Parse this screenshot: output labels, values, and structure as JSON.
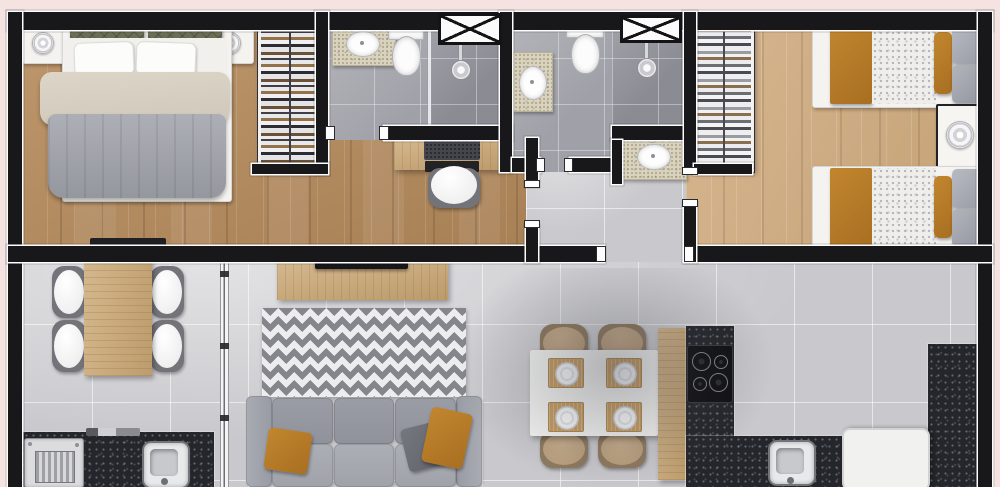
{
  "meta": {
    "title": "apartment-floor-plan",
    "description": "Top-down 3D rendered floor plan of a two-bedroom apartment, no visible text labels"
  },
  "palette": {
    "pink": "#f4e3e0",
    "wall": "#18181b",
    "woodA1": "#b68b5c",
    "woodA2": "#a67c4d",
    "woodB1": "#cfa97b",
    "tile": "#c9c9cd",
    "bath": "#a0a1a8",
    "bathdark": "#8a8b93",
    "granite": "#24262b",
    "speck": "#d9d2bd",
    "mustard": "#c2862e",
    "olive": "#6a6e55",
    "sofagray": "#9a9ca5",
    "rugzig": "#85868c",
    "rugbg": "#ededef",
    "tan": "#b69b79",
    "woodfurn": "#cba874",
    "whitefurn": "#f4f3f0"
  },
  "regions": {
    "master_bedroom": {
      "label": "master bedroom",
      "floor": "wood",
      "furniture": [
        "double-bed",
        "nightstand-left",
        "nightstand-right",
        "table-lamps",
        "open-wardrobe",
        "tv-shelf"
      ]
    },
    "master_bathroom": {
      "label": "master bathroom",
      "floor": "gray tile",
      "furniture": [
        "vanity-sink",
        "toilet",
        "walk-in-shower",
        "shower-glass"
      ]
    },
    "home_office": {
      "label": "home office nook",
      "floor": "wood",
      "furniture": [
        "desk",
        "laptop",
        "desk-chair"
      ]
    },
    "hallway": {
      "label": "hallway",
      "floor": "light tile"
    },
    "bathroom_2": {
      "label": "second bathroom",
      "floor": "gray tile",
      "furniture": [
        "vanity-sink",
        "toilet",
        "walk-in-shower"
      ]
    },
    "washbasin_nook": {
      "label": "washbasin nook",
      "floor": "light tile",
      "furniture": [
        "washbasin-vanity"
      ]
    },
    "bedroom_2": {
      "label": "second bedroom (twin)",
      "floor": "light wood",
      "furniture": [
        "single-bed-top",
        "single-bed-bottom",
        "shared-nightstand",
        "table-lamp",
        "open-wardrobe"
      ]
    },
    "balcony_dining": {
      "label": "balcony dining and laundry",
      "floor": "light tile",
      "furniture": [
        "dining-table",
        "four-white-chairs",
        "laundry-counter",
        "washboard-sink",
        "utility-sink",
        "sliding-glass-door"
      ]
    },
    "living_room": {
      "label": "living room",
      "floor": "light tile",
      "furniture": [
        "tv-console",
        "tv",
        "chevron-rug",
        "three-seat-sofa",
        "throw-pillows"
      ]
    },
    "kitchen": {
      "label": "kitchen and dining",
      "floor": "gray tile",
      "furniture": [
        "white-table",
        "four-tan-chairs",
        "place-settings",
        "peninsula-counter",
        "cooktop",
        "granite-counters",
        "kitchen-sink",
        "refrigerator"
      ]
    }
  },
  "markers": {
    "shaft_1": "ventilation-shaft-x-marker",
    "shaft_2": "ventilation-shaft-x-marker",
    "windows": [
      "left-bedroom-window",
      "left-balcony-window",
      "right-bedroom2-window",
      "right-kitchen-window-upper",
      "right-kitchen-window-lower"
    ]
  }
}
